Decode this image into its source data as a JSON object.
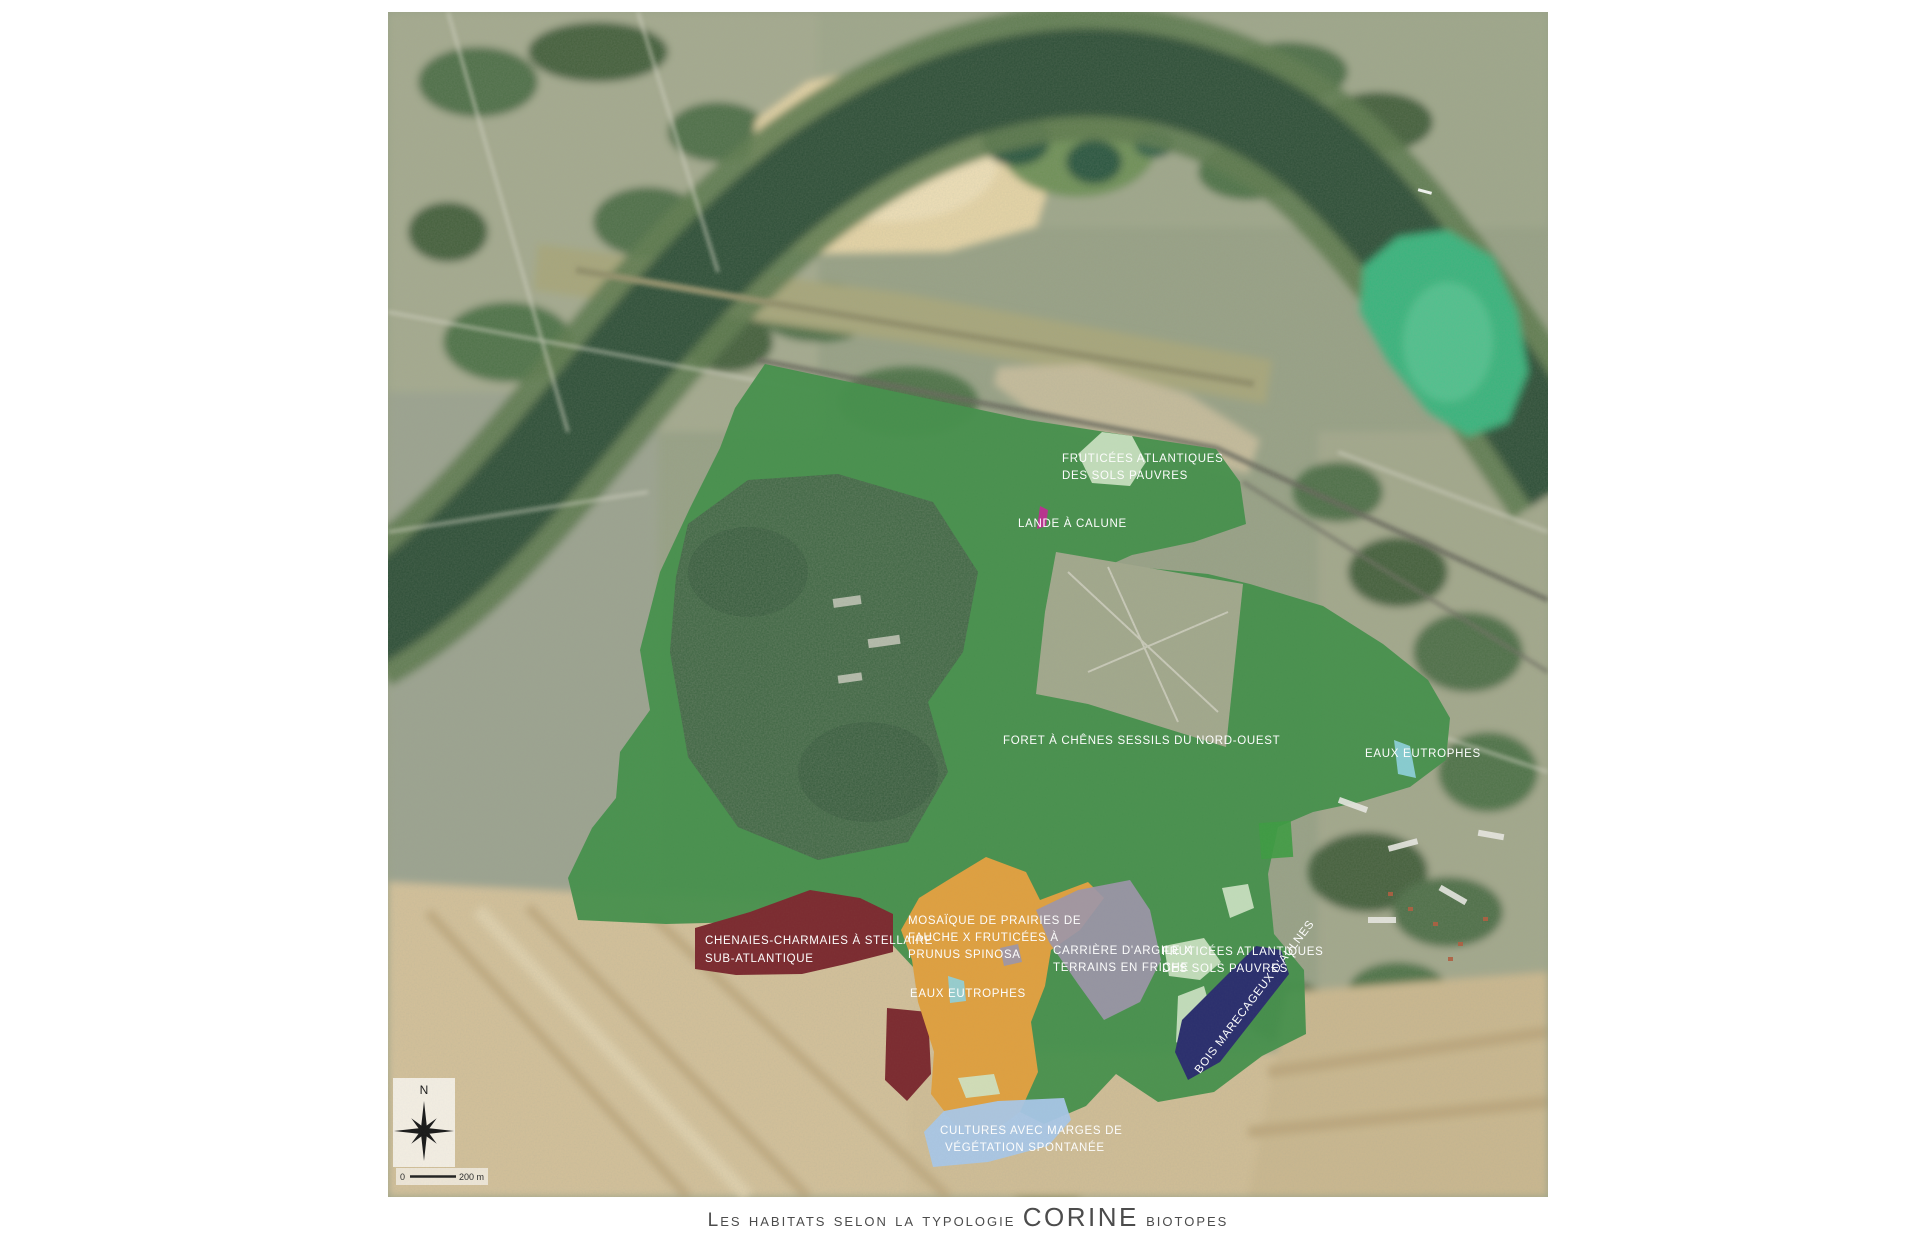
{
  "caption": {
    "prefix": "Les habitats selon la typologie ",
    "brand": "CORINE",
    "suffix": " biotopes"
  },
  "compass": {
    "north_label": "N"
  },
  "scalebar": {
    "zero": "0",
    "label": "200 m"
  },
  "labels": {
    "fruticees1": {
      "line1": "FRUTICÉES ATLANTIQUES",
      "line2": "DES SOLS PAUVRES"
    },
    "lande": {
      "line1": "LANDE À CALUNE"
    },
    "foret": {
      "line1": "FORET À CHÊNES SESSILS DU NORD-OUEST"
    },
    "eaux1": {
      "line1": "EAUX EUTROPHES"
    },
    "chenaies": {
      "line1": "CHENAIES-CHARMAIES À STELLAIRE",
      "line2": "SUB-ATLANTIQUE"
    },
    "mosaique": {
      "line1": "MOSAÏQUE DE PRAIRIES DE",
      "line2": "FAUCHE X FRUTICÉES À",
      "line3": "PRUNUS SPINOSA"
    },
    "carriere": {
      "line1": "CARRIÈRE D'ARGILE X",
      "line2": "TERRAINS EN FRICHE"
    },
    "fruticees2": {
      "line1": "FRUTICÉES ATLANTIQUES",
      "line2": "DES SOLS PAUVRES"
    },
    "eaux2": {
      "line1": "EAUX EUTROPHES"
    },
    "bois": {
      "line1": "BOIS MARECAGEUX D'AULNES"
    },
    "cultures": {
      "line1": "CULTURES AVEC MARGES DE",
      "line2": "VÉGÉTATION SPONTANÉE"
    }
  },
  "colors": {
    "forest_overlay": "#47914d",
    "chenaies_maroon": "#7c2b30",
    "mosaique_orange": "#dfa041",
    "carriere_gray": "#9d96a9",
    "fruticees_lightgreen": "#cfe3c5",
    "eaux_cyan": "#8fd2de",
    "bois_navy": "#2b2f6e",
    "cultures_blue": "#a9c7e8",
    "lande_magenta": "#b8338f",
    "label_text": "#ffffff"
  }
}
